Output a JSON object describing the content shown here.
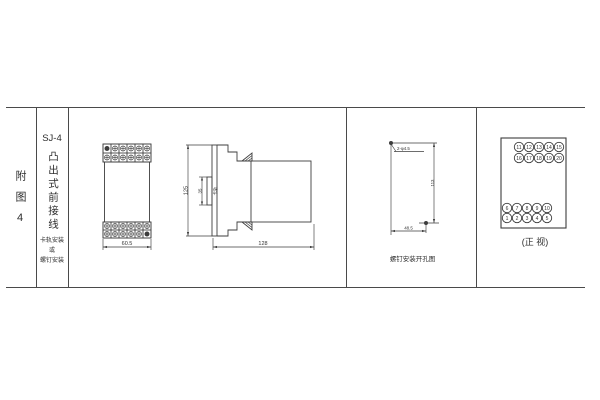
{
  "sidebar": {
    "figure_label": "附图4",
    "model": "SJ-4",
    "wiring_type": "凸出式前接线",
    "mount_note": {
      "line1": "卡轨安装",
      "line2": "或",
      "line3": "螺钉安装"
    }
  },
  "front_view": {
    "width_dim": "60.5",
    "terminal_rows": 2,
    "terminal_cols": 6
  },
  "side_view": {
    "height_dim": "125",
    "rail_width_dim": "35",
    "rail_label": "卡轨",
    "depth_dim": "128"
  },
  "hole_view": {
    "hole_spec": "2-φ4.5",
    "height_dim": "113",
    "width_dim": "48.5",
    "caption": "螺钉安装开孔图"
  },
  "terminal_view": {
    "caption": "(正 视)",
    "rows": [
      [
        "11",
        "12",
        "13",
        "14",
        "15"
      ],
      [
        "16",
        "17",
        "18",
        "19",
        "20"
      ],
      [
        "6",
        "7",
        "8",
        "9",
        "10"
      ],
      [
        "1",
        "2",
        "3",
        "4",
        "5"
      ]
    ]
  },
  "colors": {
    "line": "#3d3d3d",
    "background": "#ffffff"
  }
}
